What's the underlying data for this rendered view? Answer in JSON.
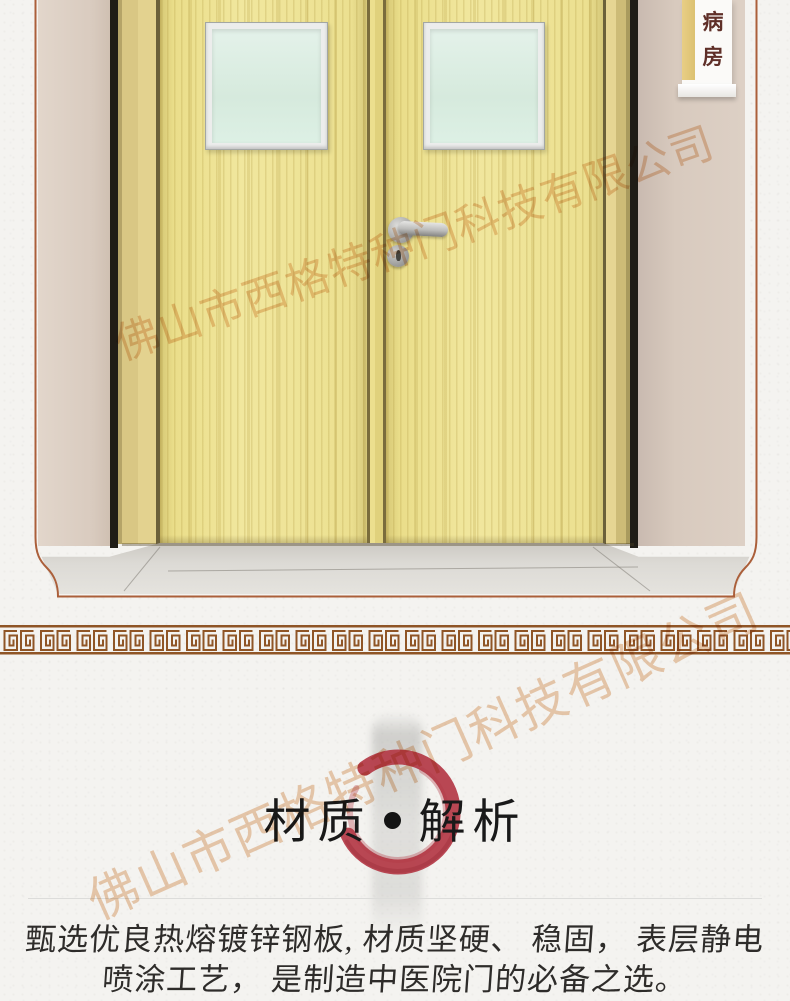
{
  "photo": {
    "sign": {
      "char1": "病",
      "char2": "房"
    },
    "watermark": "佛山市西格特种门科技有限公司"
  },
  "section": {
    "title": {
      "left": "材质",
      "separator": "•",
      "right": "解析"
    },
    "body_line1": "甄选优良热熔镀锌钢板, 材质坚硬、 稳固， 表层静电",
    "body_line2": "喷涂工艺， 是制造中医院门的必备之选。",
    "watermark": "佛山市西格特种门科技有限公司"
  },
  "colors": {
    "accent_red": "#b33845",
    "frame_line": "#ab5f3a",
    "meander_brown": "#8f5526",
    "door_yellow": "#ebdf8f",
    "wall_beige": "#d9cbbf",
    "sign_text": "#5f2f28",
    "glass_green": "#dcefe4"
  }
}
